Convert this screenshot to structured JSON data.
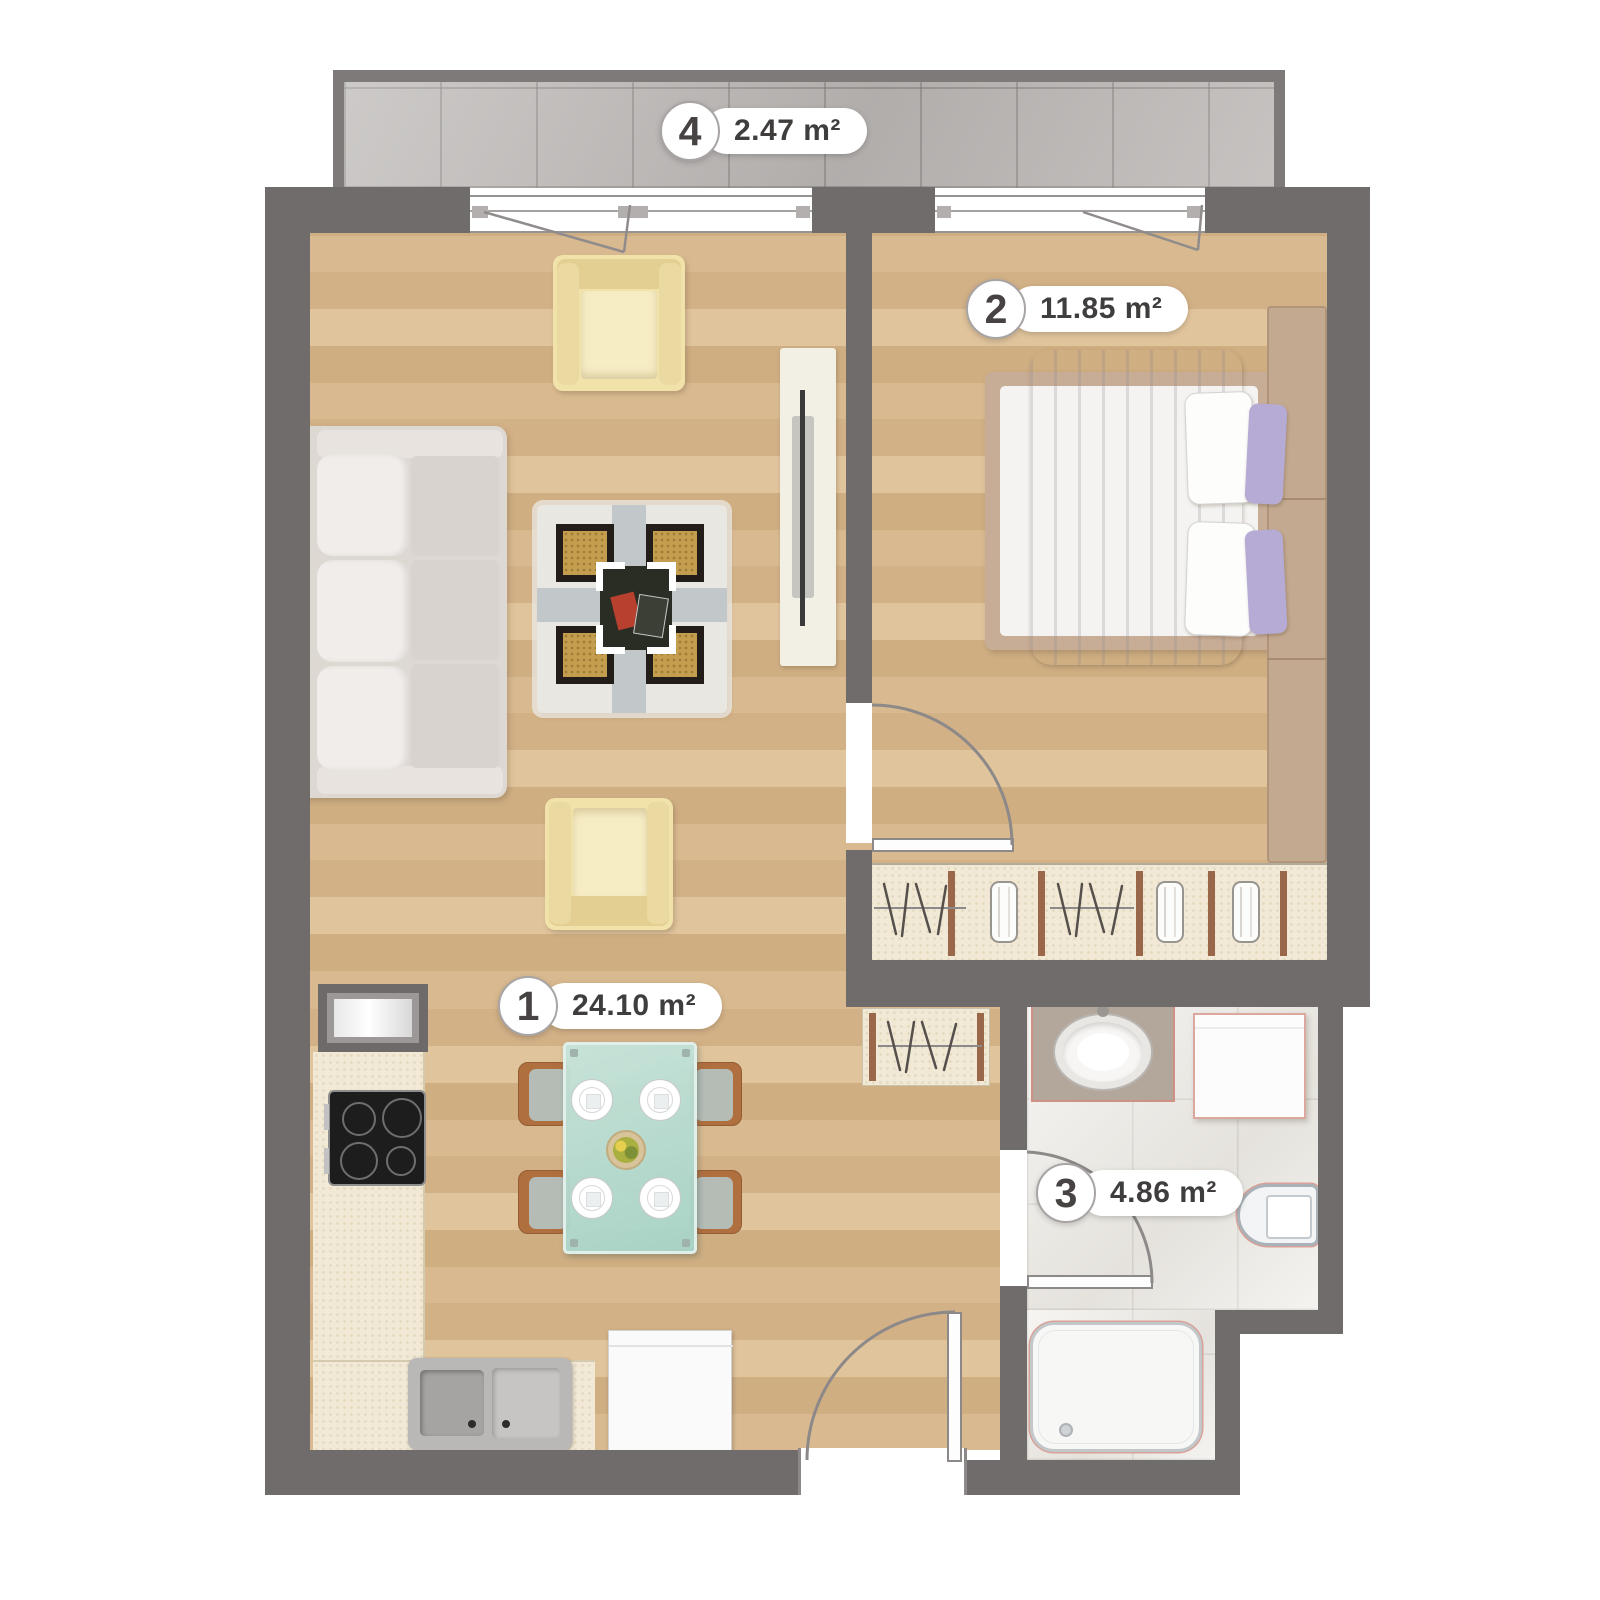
{
  "rooms": [
    {
      "number": "1",
      "area": "24.10 m²",
      "name": "living-room-kitchen"
    },
    {
      "number": "2",
      "area": "11.85 m²",
      "name": "bedroom"
    },
    {
      "number": "3",
      "area": "4.86 m²",
      "name": "bathroom"
    },
    {
      "number": "4",
      "area": "2.47 m²",
      "name": "balcony"
    }
  ],
  "colors": {
    "wall": "#716c6c",
    "wood": "#d7b68c",
    "balcony_tile": "#bcb8b6",
    "bath_tile": "#edebe6",
    "wardrobe_cream": "#f1e9d5",
    "fixture_accent": "#d08a80",
    "label_text": "#403d3d"
  }
}
